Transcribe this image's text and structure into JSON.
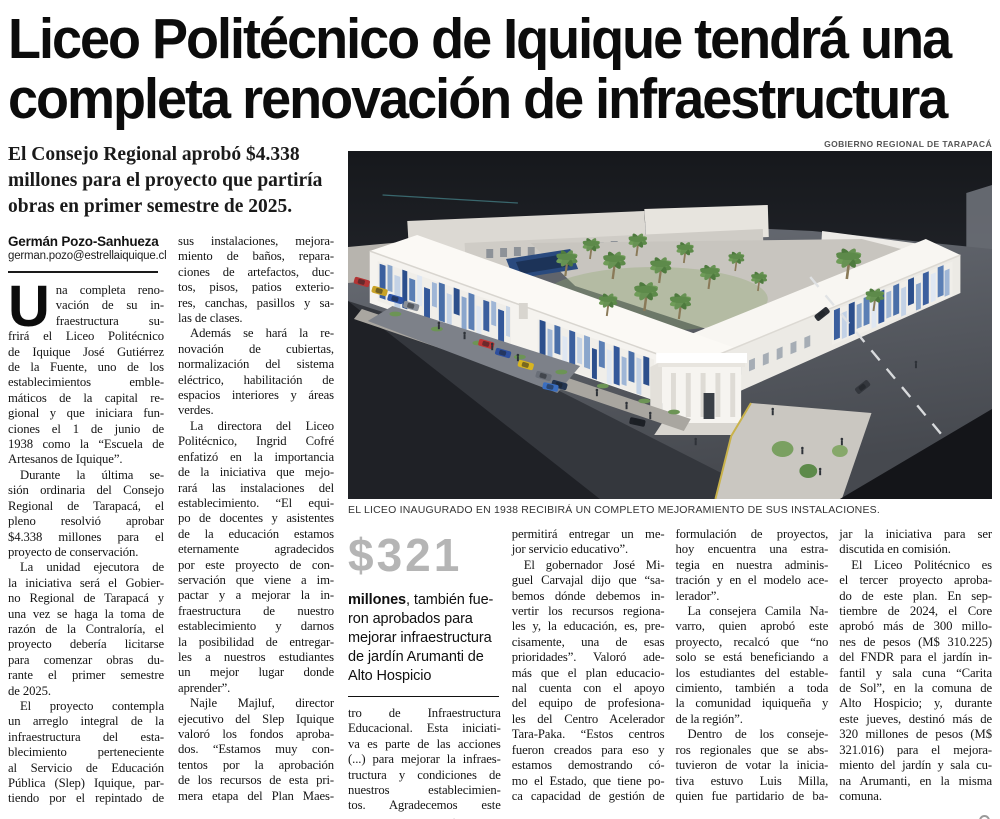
{
  "headline": {
    "line1": "Liceo Politécnico de Iquique tendrá una",
    "line2": "completa renovación de infraestructura"
  },
  "lede": {
    "lines": [
      {
        "t": "El Consejo Regional aprobó $4.338"
      },
      {
        "t": "millones para el proyecto que partiría"
      },
      {
        "t": "obras en primer semestre de 2025."
      }
    ]
  },
  "byline": {
    "author": "Germán Pozo-Sanhueza",
    "email": "german.pozo@estrellaiquique.cl"
  },
  "photo": {
    "credit": "GOBIERNO REGIONAL DE TARAPACÁ",
    "caption": "EL LICEO INAUGURADO EN 1938 RECIBIRÁ UN COMPLETO MEJORAMIENTO DE SUS INSTALACIONES.",
    "alt": "Render aéreo del Liceo Politécnico de Iquique"
  },
  "pullquote": {
    "amount": "$321",
    "bold_word": "millones",
    "line1_rest": ", también fue-",
    "lines": [
      {
        "t": "ron aprobados para"
      },
      {
        "t": "mejorar infraestructura"
      },
      {
        "t": "de jardín Arumanti de"
      },
      {
        "t": "Alto Hospicio"
      }
    ]
  },
  "article": {
    "dropcap": "U",
    "col1": [
      {
        "t": "na completa reno-"
      },
      {
        "t": "vación de su in-"
      },
      {
        "t": "fraestructura su-"
      },
      {
        "t": "frirá el Liceo Politécnico"
      },
      {
        "t": "de Iquique José Gutiérrez"
      },
      {
        "t": "de la Fuente, uno de los"
      },
      {
        "t": "establecimientos emble-"
      },
      {
        "t": "máticos de la capital re-"
      },
      {
        "t": "gional y que iniciara fun-"
      },
      {
        "t": "ciones el 1 de junio de"
      },
      {
        "t": "1938 como la “Escuela de"
      },
      {
        "t": "Artesanos de Iquique”.",
        "e": 1
      },
      {
        "t": "Durante la última se-",
        "i": 1
      },
      {
        "t": "sión ordinaria del Consejo"
      },
      {
        "t": "Regional de Tarapacá, el"
      },
      {
        "t": "pleno resolvió aprobar"
      },
      {
        "t": "$4.338 millones para el"
      },
      {
        "t": "proyecto de conservación.",
        "e": 1
      },
      {
        "t": "La unidad ejecutora de",
        "i": 1
      },
      {
        "t": "la iniciativa será el Gobier-"
      },
      {
        "t": "no Regional de Tarapacá y"
      },
      {
        "t": "una vez se haga la toma de"
      },
      {
        "t": "razón de la Contraloría, el"
      },
      {
        "t": "proyecto debería licitarse"
      },
      {
        "t": "para comenzar obras du-"
      },
      {
        "t": "rante el primer semestre"
      },
      {
        "t": "de 2025.",
        "e": 1
      },
      {
        "t": "El proyecto contempla",
        "i": 1
      },
      {
        "t": "un arreglo integral de la"
      },
      {
        "t": "infraestructura del esta-"
      },
      {
        "t": "blecimiento perteneciente"
      },
      {
        "t": "al Servicio de Educación"
      },
      {
        "t": "Pública (Slep) Iquique, par-"
      },
      {
        "t": "tiendo por el repintado de"
      }
    ],
    "col2": [
      {
        "t": "sus instalaciones, mejora-"
      },
      {
        "t": "miento de baños, repara-"
      },
      {
        "t": "ciones de artefactos, duc-"
      },
      {
        "t": "tos, pisos, patios exterio-"
      },
      {
        "t": "res, canchas, pasillos y sa-"
      },
      {
        "t": "las de clases.",
        "e": 1
      },
      {
        "t": "Además se hará la re-",
        "i": 1
      },
      {
        "t": "novación de cubiertas,"
      },
      {
        "t": "normalización del sistema"
      },
      {
        "t": "eléctrico, habilitación de"
      },
      {
        "t": "espacios interiores y áreas"
      },
      {
        "t": "verdes.",
        "e": 1
      },
      {
        "t": "La directora del Liceo",
        "i": 1
      },
      {
        "t": "Politécnico, Ingrid Cofré"
      },
      {
        "t": "enfatizó en la importancia"
      },
      {
        "t": "de la iniciativa que mejo-"
      },
      {
        "t": "rará las instalaciones del"
      },
      {
        "t": "establecimiento. “El equi-"
      },
      {
        "t": "po de docentes y asistentes"
      },
      {
        "t": "de la educación estamos"
      },
      {
        "t": "eternamente agradecidos"
      },
      {
        "t": "por este proyecto de con-"
      },
      {
        "t": "servación que viene a im-"
      },
      {
        "t": "pactar y a mejorar la in-"
      },
      {
        "t": "fraestructura de nuestro"
      },
      {
        "t": "establecimiento y darnos"
      },
      {
        "t": "la posibilidad de entregar-"
      },
      {
        "t": "les a nuestros estudiantes"
      },
      {
        "t": "un mejor lugar donde"
      },
      {
        "t": "aprender”.",
        "e": 1
      },
      {
        "t": "Najle Majluf, director",
        "i": 1
      },
      {
        "t": "ejecutivo del Slep Iquique"
      },
      {
        "t": "valoró los fondos aproba-"
      },
      {
        "t": "dos. “Estamos muy con-"
      },
      {
        "t": "tentos por la aprobación"
      },
      {
        "t": "de los recursos de esta pri-"
      },
      {
        "t": "mera etapa del Plan Maes-"
      }
    ],
    "col3": [
      {
        "t": "tro de Infraestructura"
      },
      {
        "t": "Educacional. Esta iniciati-"
      },
      {
        "t": "va es parte de las acciones"
      },
      {
        "t": "(...) para mejorar la infraes-"
      },
      {
        "t": "tructura y condiciones de"
      },
      {
        "t": "nuestros establecimien-"
      },
      {
        "t": "tos. Agradecemos este"
      },
      {
        "t": "enorme apoyo que nos"
      }
    ],
    "col4": [
      {
        "t": "permitirá entregar un me-"
      },
      {
        "t": "jor servicio educativo”.",
        "e": 1
      },
      {
        "t": "El gobernador José Mi-",
        "i": 1
      },
      {
        "t": "guel Carvajal dijo que “sa-"
      },
      {
        "t": "bemos dónde debemos in-"
      },
      {
        "t": "vertir los recursos regiona-"
      },
      {
        "t": "les y, la educación, es, pre-"
      },
      {
        "t": "cisamente, una de esas"
      },
      {
        "t": "prioridades”. Valoró ade-"
      },
      {
        "t": "más que el plan educacio-"
      },
      {
        "t": "nal cuenta con el apoyo"
      },
      {
        "t": "del equipo de profesiona-"
      },
      {
        "t": "les del Centro Acelerador"
      },
      {
        "t": "Tara-Paka. “Estos centros"
      },
      {
        "t": "fueron creados para eso y"
      },
      {
        "t": "estamos demostrando có-"
      },
      {
        "t": "mo el Estado, que tiene po-"
      },
      {
        "t": "ca capacidad de gestión de"
      }
    ],
    "col5": [
      {
        "t": "formulación de proyectos,"
      },
      {
        "t": "hoy encuentra una estra-"
      },
      {
        "t": "tegia en nuestra adminis-"
      },
      {
        "t": "tración y en el modelo ace-"
      },
      {
        "t": "lerador”.",
        "e": 1
      },
      {
        "t": "La consejera Camila Na-",
        "i": 1
      },
      {
        "t": "varro, quien aprobó este"
      },
      {
        "t": "proyecto, recalcó que “no"
      },
      {
        "t": "solo se está beneficiando a"
      },
      {
        "t": "los estudiantes del estable-"
      },
      {
        "t": "cimiento, también a toda"
      },
      {
        "t": "la comunidad iquiqueña y"
      },
      {
        "t": "de la región”.",
        "e": 1
      },
      {
        "t": "Dentro de los conseje-",
        "i": 1
      },
      {
        "t": "ros regionales que se abs-"
      },
      {
        "t": "tuvieron de votar la inicia-"
      },
      {
        "t": "tiva estuvo Luis Milla,"
      },
      {
        "t": "quien fue partidario de ba-"
      }
    ],
    "col6": [
      {
        "t": "jar la iniciativa para ser"
      },
      {
        "t": "discutida en comisión.",
        "e": 1
      },
      {
        "t": "El Liceo Politécnico es",
        "i": 1
      },
      {
        "t": "el tercer proyecto aproba-"
      },
      {
        "t": "do de este plan. En sep-"
      },
      {
        "t": "tiembre de 2024, el Core"
      },
      {
        "t": "aprobó más de 300 millo-"
      },
      {
        "t": "nes de pesos (M$ 310.225)"
      },
      {
        "t": "del FNDR para el jardín in-"
      },
      {
        "t": "fantil y sala cuna “Carita"
      },
      {
        "t": "de Sol”, en la comuna de"
      },
      {
        "t": "Alto Hospicio; y, durante"
      },
      {
        "t": "este jueves, destinó más de"
      },
      {
        "t": "320 millones de pesos (M$"
      },
      {
        "t": "321.016) para el mejora-"
      },
      {
        "t": "miento del jardín y sala cu-"
      },
      {
        "t": "na Arumanti, en la misma"
      },
      {
        "t": "comuna.",
        "e": 1
      }
    ]
  },
  "icons": {
    "article_end": "ring"
  },
  "colors": {
    "page_bg": "#ffffff",
    "text": "#111111",
    "pullquote_number": "#b5b5b5",
    "photo_sky": "#23262b",
    "photo_ground": "#565a62",
    "building_white": "#f5f3ef",
    "mosaic_blue": "#3b5f9e",
    "palm_green": "#5d8a4a"
  }
}
